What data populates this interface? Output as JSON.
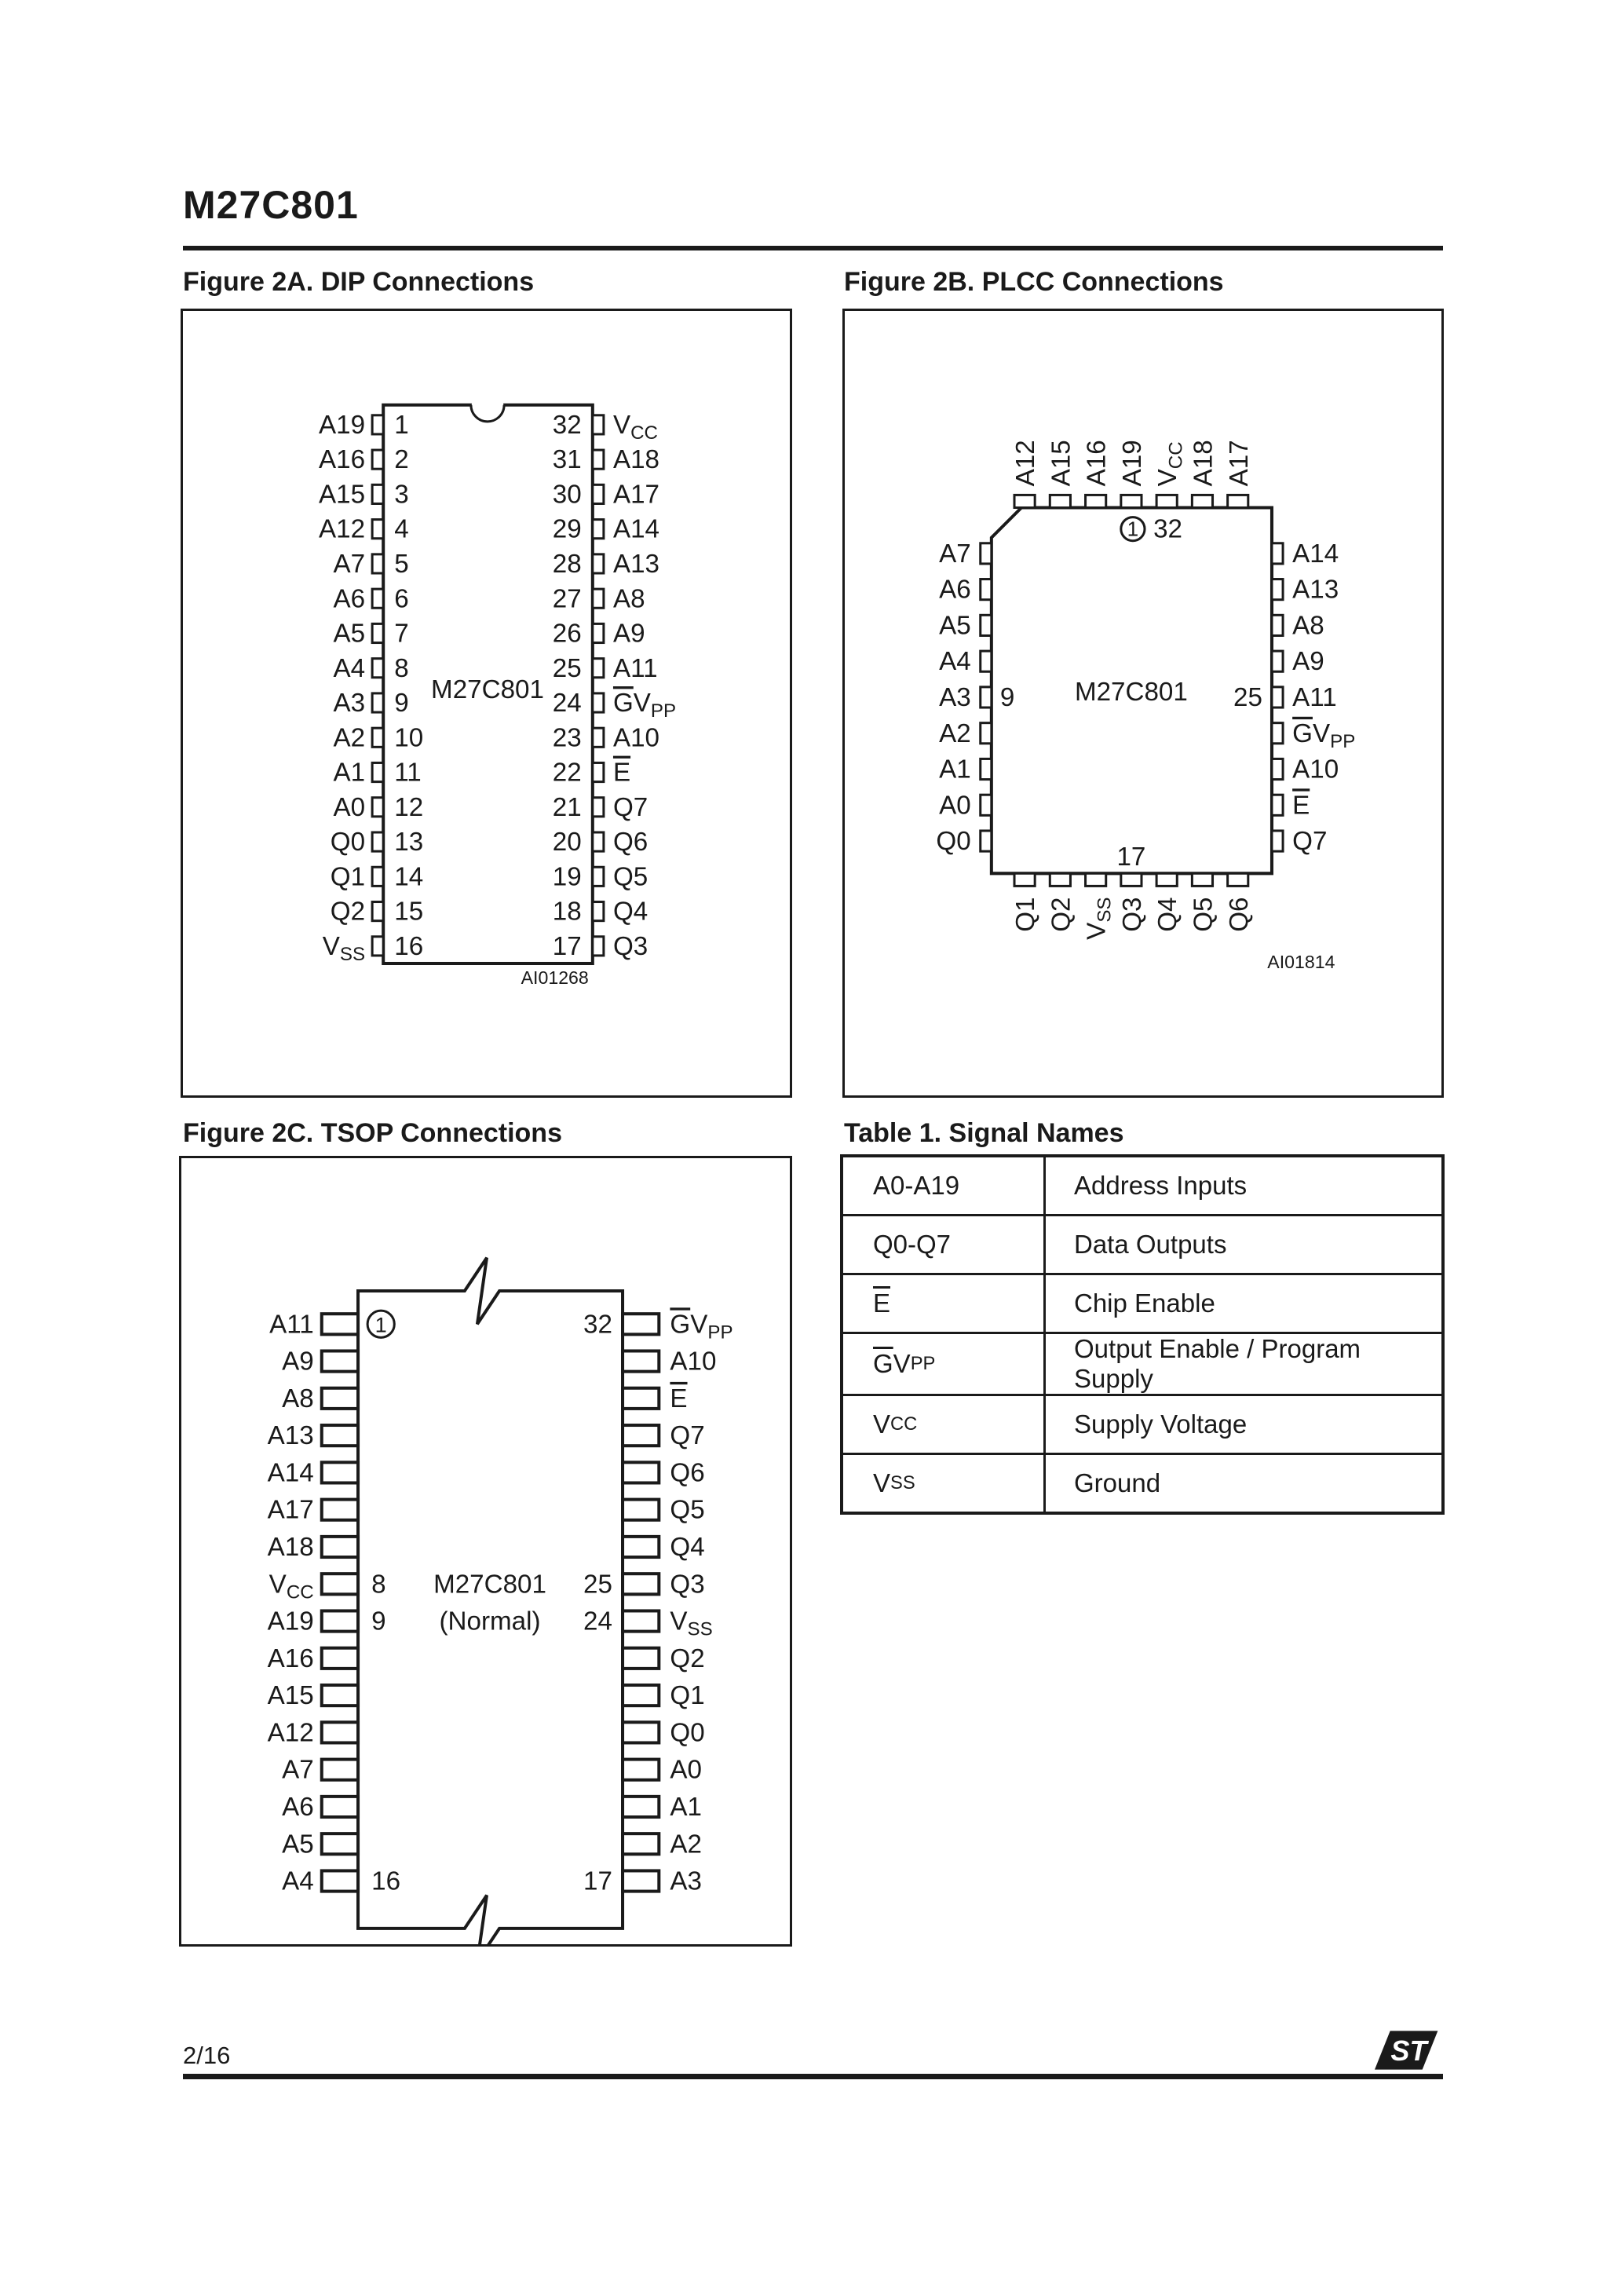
{
  "page": {
    "title": "M27C801",
    "page_number": "2/16",
    "brand": "ST"
  },
  "figure_dip": {
    "title": "Figure 2A. DIP Connections",
    "chip_label": "M27C801",
    "caption": "AI01268",
    "left_pins": [
      {
        "name": "A19",
        "num": "1"
      },
      {
        "name": "A16",
        "num": "2"
      },
      {
        "name": "A15",
        "num": "3"
      },
      {
        "name": "A12",
        "num": "4"
      },
      {
        "name": "A7",
        "num": "5"
      },
      {
        "name": "A6",
        "num": "6"
      },
      {
        "name": "A5",
        "num": "7"
      },
      {
        "name": "A4",
        "num": "8"
      },
      {
        "name": "A3",
        "num": "9"
      },
      {
        "name": "A2",
        "num": "10"
      },
      {
        "name": "A1",
        "num": "11"
      },
      {
        "name": "A0",
        "num": "12"
      },
      {
        "name": "Q0",
        "num": "13"
      },
      {
        "name": "Q1",
        "num": "14"
      },
      {
        "name": "Q2",
        "num": "15"
      },
      {
        "name": "VSS",
        "num": "16"
      }
    ],
    "right_pins": [
      {
        "name": "VCC",
        "num": "32"
      },
      {
        "name": "A18",
        "num": "31"
      },
      {
        "name": "A17",
        "num": "30"
      },
      {
        "name": "A14",
        "num": "29"
      },
      {
        "name": "A13",
        "num": "28"
      },
      {
        "name": "A8",
        "num": "27"
      },
      {
        "name": "A9",
        "num": "26"
      },
      {
        "name": "A11",
        "num": "25"
      },
      {
        "name": "GVPP",
        "num": "24"
      },
      {
        "name": "A10",
        "num": "23"
      },
      {
        "name": "E",
        "num": "22"
      },
      {
        "name": "Q7",
        "num": "21"
      },
      {
        "name": "Q6",
        "num": "20"
      },
      {
        "name": "Q5",
        "num": "19"
      },
      {
        "name": "Q4",
        "num": "18"
      },
      {
        "name": "Q3",
        "num": "17"
      }
    ]
  },
  "figure_plcc": {
    "title": "Figure 2B. PLCC Connections",
    "chip_label": "M27C801",
    "caption": "AI01814",
    "top_pins": [
      "A12",
      "A15",
      "A16",
      "A19",
      "VCC",
      "A18",
      "A17"
    ],
    "left_pins": [
      "A7",
      "A6",
      "A5",
      "A4",
      "A3",
      "A2",
      "A1",
      "A0",
      "Q0"
    ],
    "right_pins": [
      "A14",
      "A13",
      "A8",
      "A9",
      "A11",
      "GVPP",
      "A10",
      "E",
      "Q7"
    ],
    "bottom_pins": [
      "Q1",
      "Q2",
      "VSS",
      "Q3",
      "Q4",
      "Q5",
      "Q6"
    ],
    "markers": {
      "pin1": "1",
      "pin32": "32",
      "left": "9",
      "right": "25",
      "bottom": "17"
    }
  },
  "figure_tsop": {
    "title": "Figure 2C. TSOP Connections",
    "chip_label_1": "M27C801",
    "chip_label_2": "(Normal)",
    "caption": "AI01269",
    "left_pins": [
      "A11",
      "A9",
      "A8",
      "A13",
      "A14",
      "A17",
      "A18",
      "VCC",
      "A19",
      "A16",
      "A15",
      "A12",
      "A7",
      "A6",
      "A5",
      "A4"
    ],
    "right_pins": [
      "GVPP",
      "A10",
      "E",
      "Q7",
      "Q6",
      "Q5",
      "Q4",
      "Q3",
      "VSS",
      "Q2",
      "Q1",
      "Q0",
      "A0",
      "A1",
      "A2",
      "A3"
    ],
    "markers": {
      "pin1": "1",
      "num8": "8",
      "num9": "9",
      "num16": "16",
      "num32": "32",
      "num25": "25",
      "num24": "24",
      "num17": "17"
    }
  },
  "signal_table": {
    "title": "Table 1. Signal Names",
    "rows": [
      {
        "signal": "A0-A19",
        "description": "Address Inputs"
      },
      {
        "signal": "Q0-Q7",
        "description": "Data Outputs"
      },
      {
        "signal": "E",
        "description": "Chip Enable"
      },
      {
        "signal": "GVPP",
        "description": "Output Enable / Program Supply"
      },
      {
        "signal": "VCC",
        "description": "Supply Voltage"
      },
      {
        "signal": "VSS",
        "description": "Ground"
      }
    ]
  }
}
